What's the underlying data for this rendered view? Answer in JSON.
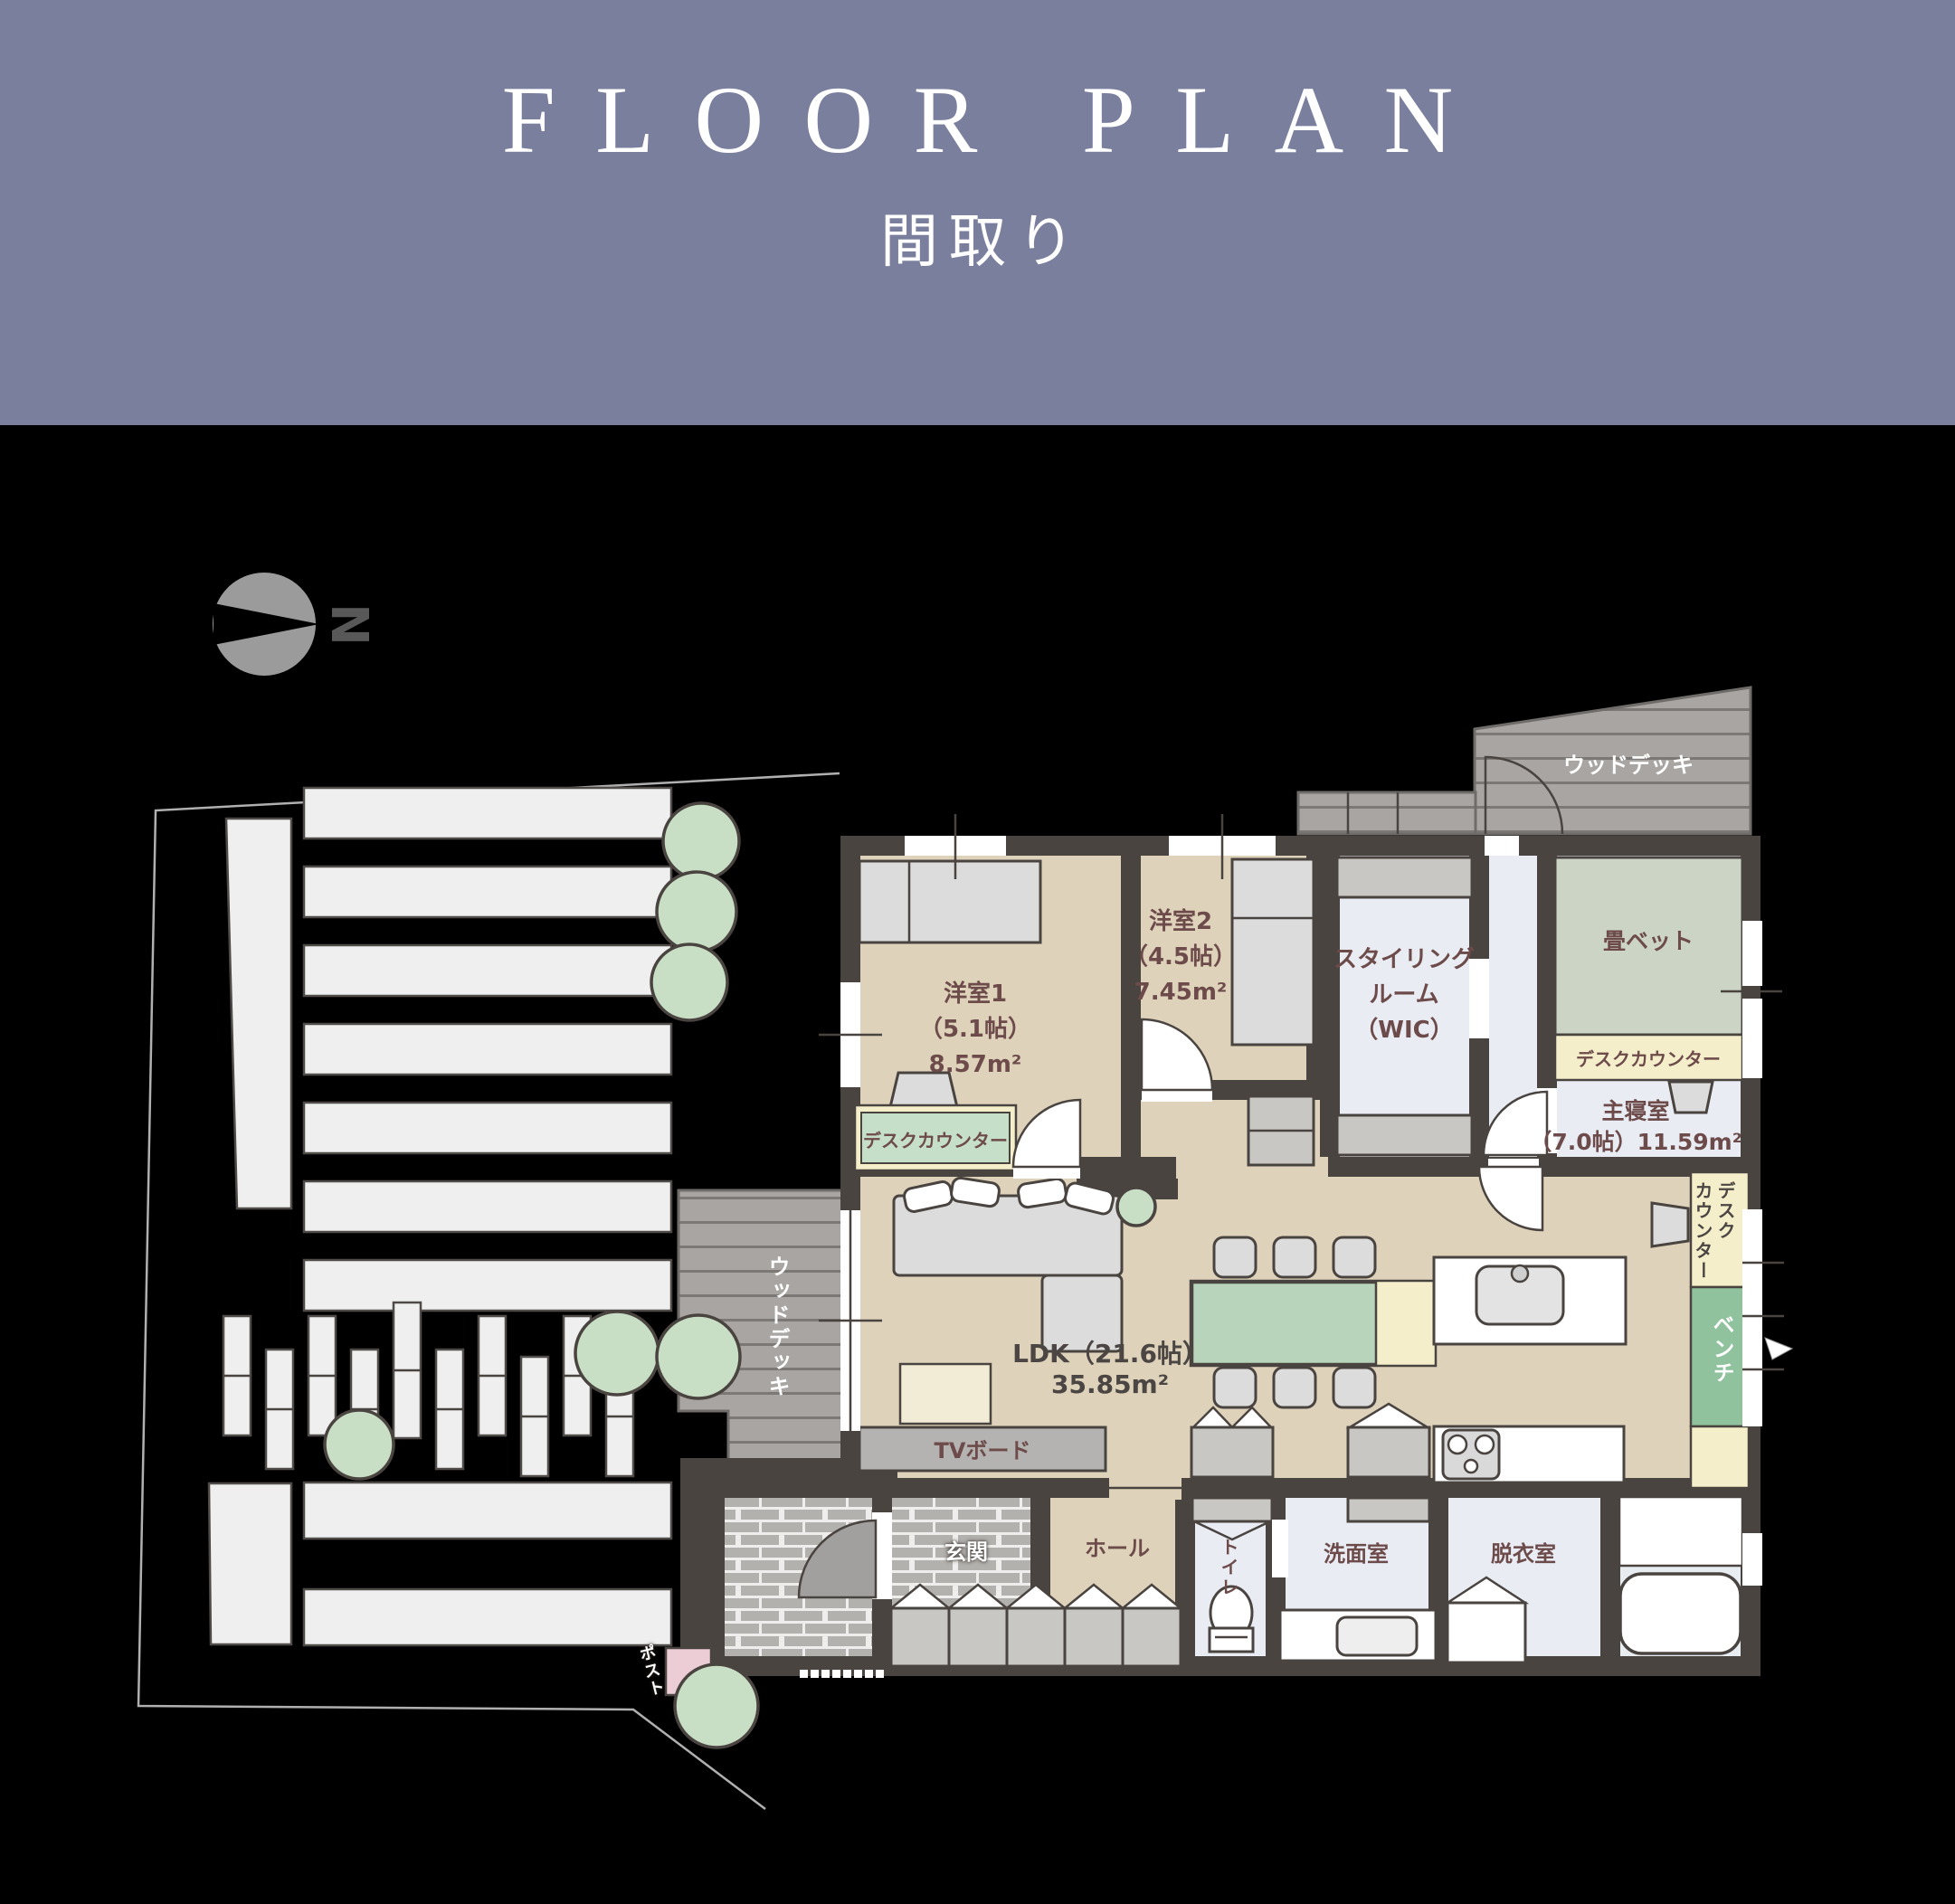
{
  "header": {
    "title": "FLOOR PLAN",
    "subtitle": "間取り"
  },
  "compass": {
    "north_label": "N"
  },
  "rooms": {
    "yoshitsu1": {
      "name": "洋室1",
      "size": "（5.1帖）",
      "area": "8.57m²",
      "desk_counter": "デスクカウンター"
    },
    "yoshitsu2": {
      "name": "洋室2",
      "size": "（4.5帖）",
      "area": "7.45m²"
    },
    "styling_room": {
      "line1": "スタイリング",
      "line2": "ルーム",
      "line3": "（WIC）"
    },
    "master_bedroom": {
      "name": "主寝室",
      "size_area": "（7.0帖）11.59m²",
      "tatami_bed": "畳ベット",
      "desk_counter": "デスクカウンター"
    },
    "ldk": {
      "name": "LDK（21.6帖）",
      "area": "35.85m²"
    },
    "genkan": {
      "name": "玄関"
    },
    "hall": {
      "name": "ホール"
    },
    "toilet": {
      "name": "トイレ"
    },
    "washroom": {
      "name": "洗面室"
    },
    "dressing_room": {
      "name": "脱衣室"
    }
  },
  "features": {
    "tv_board": "TVボード",
    "desk_counter_col1": "デスク",
    "desk_counter_col2": "カウンター",
    "bench": "ベンチ",
    "wood_deck_left": "ウッドデッキ",
    "wood_deck_top": "ウッドデッキ",
    "post": "ポスト"
  },
  "colors": {
    "header_bg": "#7a7f9e",
    "wall": "#4a4441",
    "floor_beige": "#ded3ba",
    "floor_light": "#e9edf3",
    "tatami_green": "#ccd5c5",
    "table_green": "#b8d5bb",
    "bench_green": "#90c29e",
    "counter_green": "#c6dfc8",
    "cream": "#f5eecb",
    "rug_cream": "#f2ecd7",
    "furniture_gray": "#dcdcdc",
    "closet_gray": "#c9c7c4",
    "tv_gray": "#b5b3b1",
    "deck_gray": "#a8a5a2",
    "deck_line": "#7b7875",
    "brick_gray": "#b3b1ae",
    "stripe_white": "#efefef",
    "tree_green": "#c9dfc5",
    "label_maroon": "#6d4b4b",
    "label_dark": "#4b4643",
    "compass_gray": "#9b9b9b",
    "pink": "#eccdd5",
    "site_line": "#b0b0b0"
  }
}
